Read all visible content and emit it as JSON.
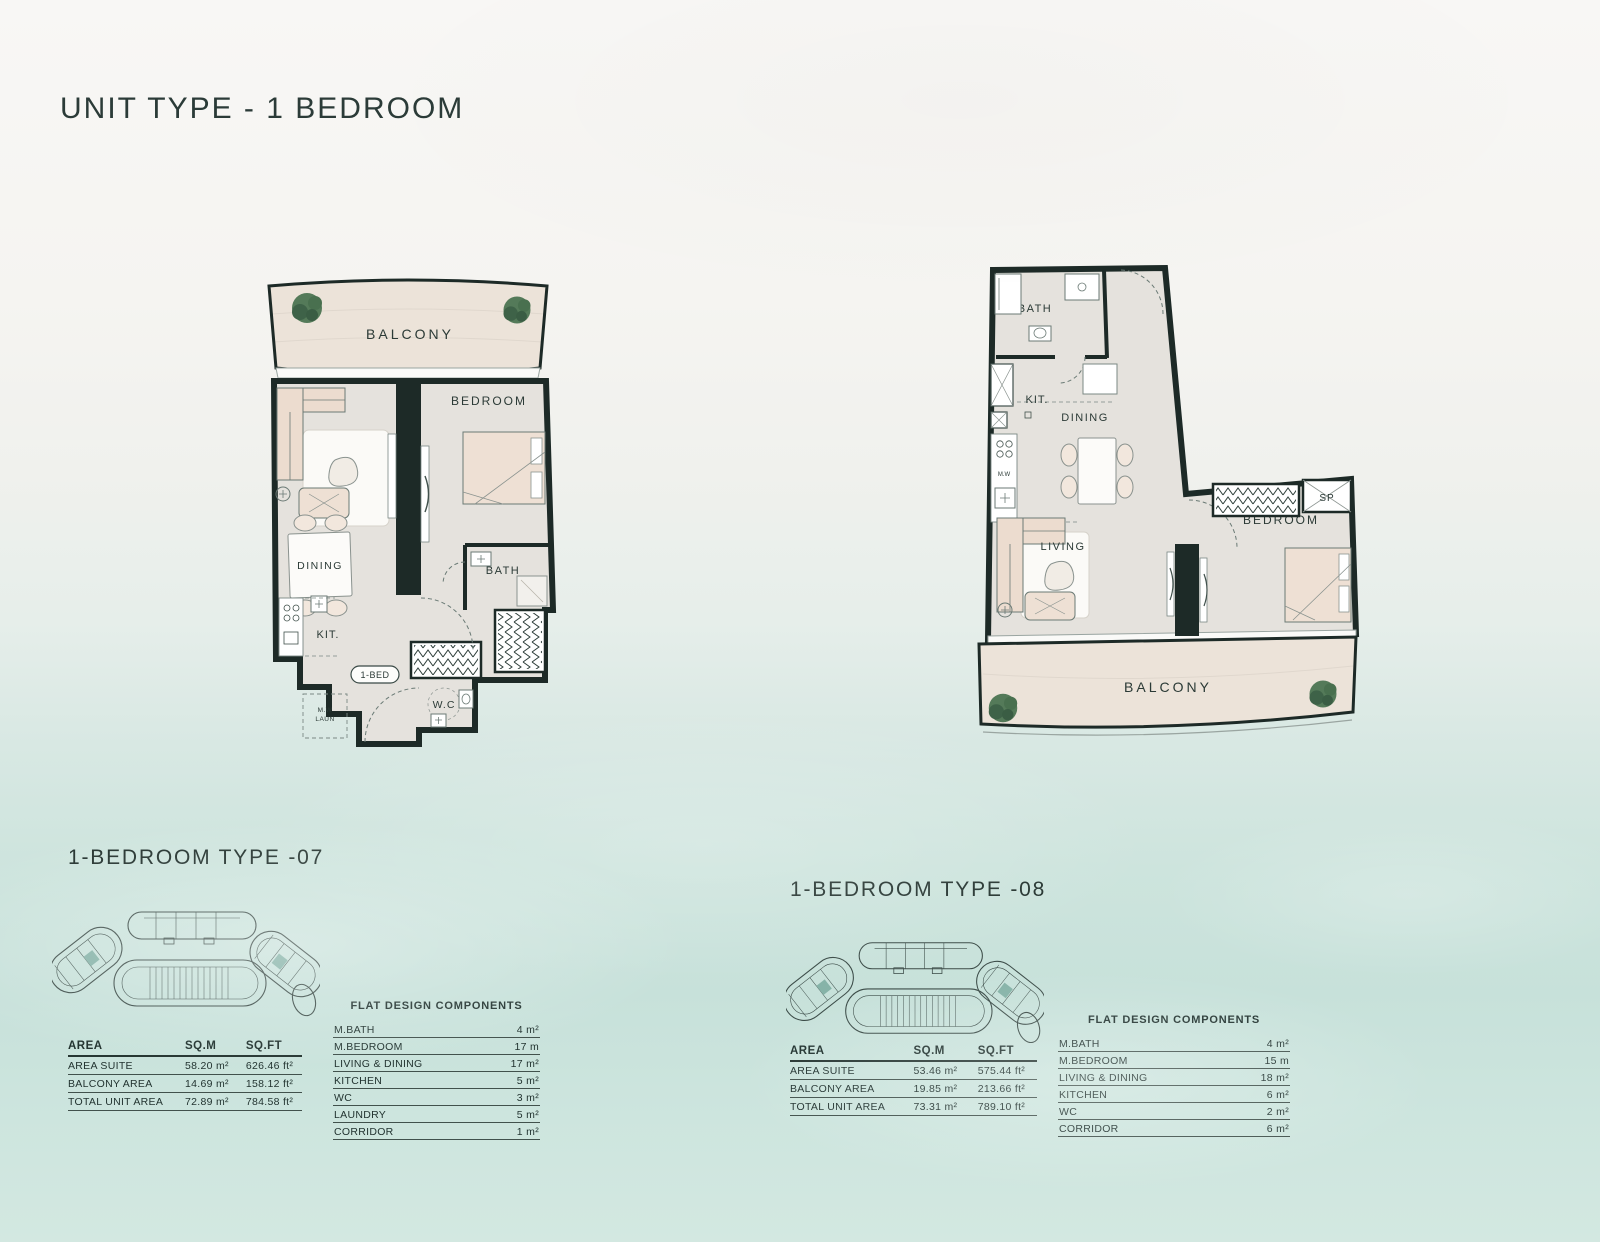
{
  "page": {
    "title": "UNIT TYPE - 1 BEDROOM"
  },
  "plans": [
    {
      "name": "1-BEDROOM TYPE -07",
      "rooms": {
        "balcony": "BALCONY",
        "bedroom": "BEDROOM",
        "dining": "DINING",
        "kitchen": "KIT.",
        "bath": "BATH",
        "wc": "W.C",
        "unit_tag": "1-BED",
        "laundry_top": "M.W",
        "laundry_bottom": "LAUN"
      },
      "area_table": {
        "headers": [
          "AREA",
          "SQ.M",
          "SQ.FT"
        ],
        "rows": [
          {
            "label": "AREA SUITE",
            "sqm": "58.20 m²",
            "sqft": "626.46 ft²"
          },
          {
            "label": "BALCONY AREA",
            "sqm": "14.69 m²",
            "sqft": "158.12 ft²"
          },
          {
            "label": "TOTAL UNIT AREA",
            "sqm": "72.89 m²",
            "sqft": "784.58 ft²"
          }
        ]
      },
      "components": {
        "title": "FLAT DESIGN COMPONENTS",
        "rows": [
          {
            "label": "M.BATH",
            "value": "4 m²"
          },
          {
            "label": "M.BEDROOM",
            "value": "17 m"
          },
          {
            "label": "LIVING & DINING",
            "value": "17 m²"
          },
          {
            "label": "KITCHEN",
            "value": "5 m²"
          },
          {
            "label": "WC",
            "value": "3 m²"
          },
          {
            "label": "LAUNDRY",
            "value": "5 m²"
          },
          {
            "label": "CORRIDOR",
            "value": "1 m²"
          }
        ]
      }
    },
    {
      "name": "1-BEDROOM TYPE -08",
      "rooms": {
        "balcony": "BALCONY",
        "bedroom": "BEDROOM",
        "dining": "DINING",
        "kitchen": "KIT.",
        "bath": "BATH",
        "living": "LIVING",
        "storage": "SP",
        "washer": "M.W"
      },
      "area_table": {
        "headers": [
          "AREA",
          "SQ.M",
          "SQ.FT"
        ],
        "rows": [
          {
            "label": "AREA SUITE",
            "sqm": "53.46 m²",
            "sqft": "575.44 ft²"
          },
          {
            "label": "BALCONY AREA",
            "sqm": "19.85 m²",
            "sqft": "213.66 ft²"
          },
          {
            "label": "TOTAL UNIT AREA",
            "sqm": "73.31 m²",
            "sqft": "789.10 ft²"
          }
        ]
      },
      "components": {
        "title": "FLAT DESIGN COMPONENTS",
        "rows": [
          {
            "label": "M.BATH",
            "value": "4 m²"
          },
          {
            "label": "M.BEDROOM",
            "value": "15 m"
          },
          {
            "label": "LIVING & DINING",
            "value": "18 m²"
          },
          {
            "label": "KITCHEN",
            "value": "6 m²"
          },
          {
            "label": "WC",
            "value": "2 m²"
          },
          {
            "label": "CORRIDOR",
            "value": "6 m²"
          }
        ]
      }
    }
  ],
  "colors": {
    "wall": "#1d2a27",
    "floor": "#e5e2dd",
    "balcony_floor": "#ece3d9",
    "furniture": "#ecdccf",
    "tree_green": "#4f7856",
    "text": "#223330",
    "water": "#c9e4dd"
  }
}
